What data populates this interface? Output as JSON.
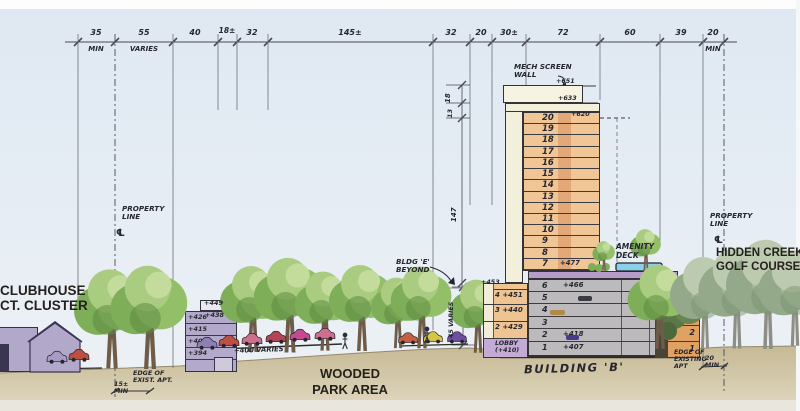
{
  "drawing": {
    "type": "architectural site section sketch",
    "palette": {
      "sky": "#dfe8f2",
      "ground": "#cbbf9f",
      "tower_peach": "#f1c697",
      "tower_core": "#e3a877",
      "cream": "#f2efda",
      "podium_gray": "#bdbabd",
      "purple_building": "#b3a9ca",
      "lobby_purple": "#c3abd6",
      "slab_purple": "#b79bc8",
      "pool_blue": "#8ccfe9",
      "right_building_orange": "#dfa164",
      "park_tree_green": "#93bf68",
      "golf_tree_green": "#a7bb9b",
      "ink": "#26262e"
    }
  },
  "dims": [
    {
      "v": "35",
      "sub": "MIN"
    },
    {
      "v": "55",
      "sub": "VARIES"
    },
    {
      "v": "40",
      "sub": ""
    },
    {
      "v": "18±",
      "sub": ""
    },
    {
      "v": "32",
      "sub": ""
    },
    {
      "v": "145±",
      "sub": ""
    },
    {
      "v": "32",
      "sub": ""
    },
    {
      "v": "20",
      "sub": ""
    },
    {
      "v": "30±",
      "sub": ""
    },
    {
      "v": "72",
      "sub": ""
    },
    {
      "v": "60",
      "sub": ""
    },
    {
      "v": "39",
      "sub": ""
    },
    {
      "v": "20",
      "sub": "MIN"
    }
  ],
  "vdims": {
    "d18": "18",
    "d13": "13",
    "d147": "147",
    "d45": "45 VARIES"
  },
  "tower": {
    "mech1": "MECH SCREEN",
    "mech2": "WALL",
    "e651": "+651",
    "e633": "+633",
    "e620": "+620",
    "e477": "+477",
    "upper": [
      "20",
      "19",
      "18",
      "17",
      "16",
      "15",
      "14",
      "13",
      "12",
      "11",
      "10",
      "9",
      "8",
      "7"
    ],
    "podium": [
      {
        "n": "6",
        "e": "+466"
      },
      {
        "n": "5",
        "e": ""
      },
      {
        "n": "4",
        "e": ""
      },
      {
        "n": "3",
        "e": ""
      },
      {
        "n": "2",
        "e": "+418"
      },
      {
        "n": "1",
        "e": "+407"
      }
    ],
    "amenity1": "AMENITY",
    "amenity2": "DECK",
    "name": "BUILDING 'B'"
  },
  "annex": {
    "top": "+453",
    "rows": [
      {
        "n": "4",
        "e": "+451"
      },
      {
        "n": "3",
        "e": "+440"
      },
      {
        "n": "2",
        "e": "+429"
      },
      {
        "n": "LOBBY",
        "e": "(+410)"
      }
    ]
  },
  "midrise": {
    "elevs": [
      "+449",
      "+438",
      "+426",
      "+415",
      "+404",
      "+394"
    ]
  },
  "notes": {
    "ground": "+400 VARIES"
  },
  "rightbldg": {
    "floors": [
      "4",
      "3",
      "2",
      "1"
    ]
  },
  "labels": {
    "clubhouse1": "CLUBHOUSE",
    "clubhouse2": "CT. CLUSTER",
    "wooded1": "WOODED",
    "wooded2": "PARK AREA",
    "golf1": "HIDDEN CREEK",
    "golf2": "GOLF COURSE",
    "prop1": "PROPERTY",
    "prop2": "LINE",
    "cl": "℄",
    "bldge1": "BLDG 'E'",
    "bldge2": "BEYOND",
    "edgel1": "EDGE OF",
    "edgel2": "EXIST. APT.",
    "edgel_d1": "15±",
    "edgel_d2": "MIN",
    "edger1": "EDGE OF",
    "edger2": "EXISTING",
    "edger3": "APT",
    "edger_d1": "20",
    "edger_d2": "MIN"
  }
}
